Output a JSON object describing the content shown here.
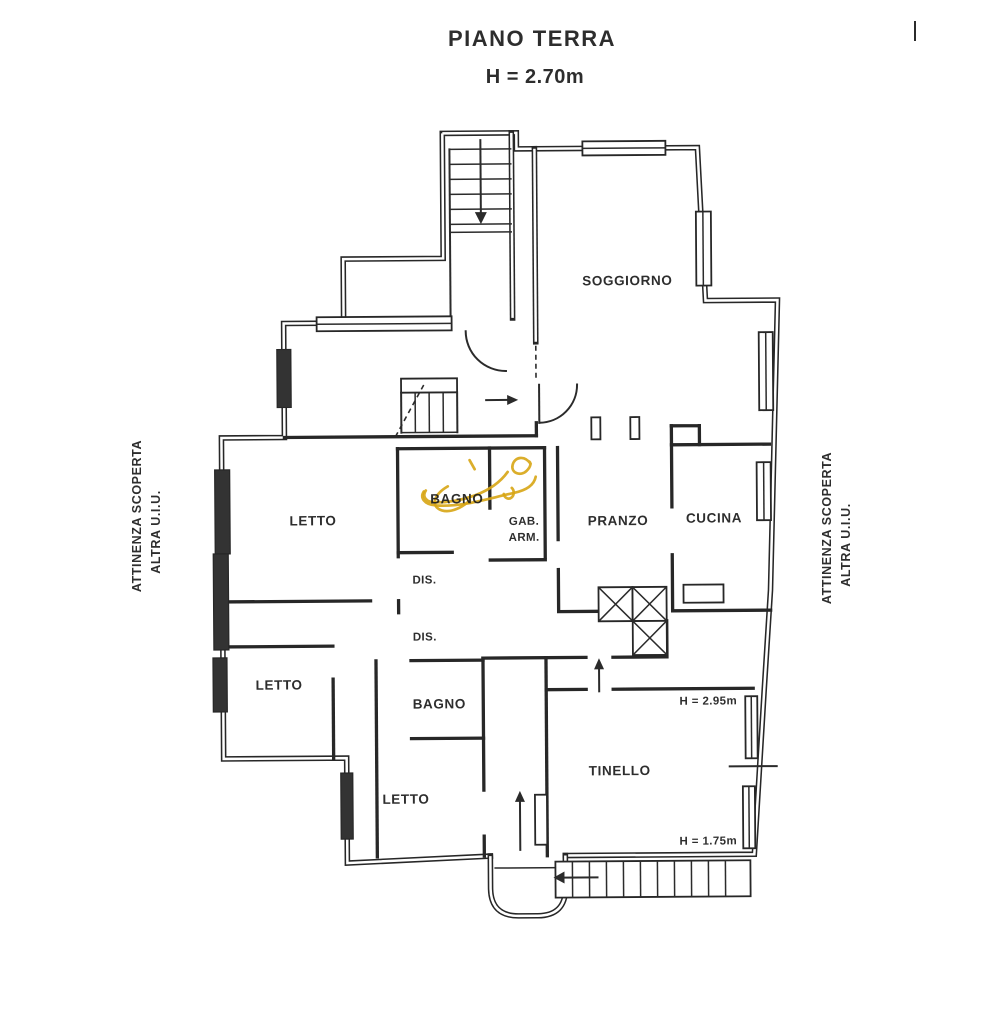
{
  "header": {
    "title": "PIANO TERRA",
    "height_note": "H = 2.70m"
  },
  "margin_notes": {
    "left": {
      "line1": "ATTINENZA SCOPERTA",
      "line2": "ALTRA U.I.U."
    },
    "right": {
      "line1": "ATTINENZA SCOPERTA",
      "line2": "ALTRA U.I.U."
    }
  },
  "rooms": {
    "soggiorno": "SOGGIORNO",
    "letto_1": "LETTO",
    "bagno_1": "BAGNO",
    "gab_arm_line1": "GAB.",
    "gab_arm_line2": "ARM.",
    "pranzo": "PRANZO",
    "cucina": "CUCINA",
    "dis_1": "DIS.",
    "dis_2": "DIS.",
    "letto_2": "LETTO",
    "bagno_2": "BAGNO",
    "letto_3": "LETTO",
    "tinello": "TINELLO"
  },
  "annotations": {
    "tinello_height": "H = 2.95m",
    "veranda_height": "H = 1.75m"
  },
  "colors": {
    "ink": "#272727",
    "highlight": "#d7a514",
    "paper": "#ffffff"
  }
}
